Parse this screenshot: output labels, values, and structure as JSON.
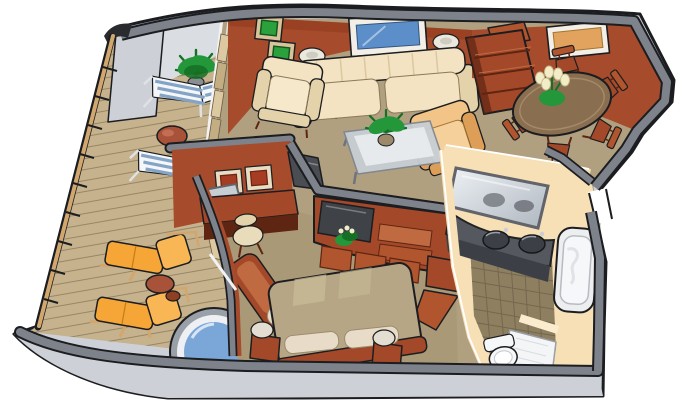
{
  "scene": {
    "kind": "isometric-suite-floorplan",
    "background": "#ffffff",
    "rooms": [
      {
        "name": "balcony",
        "furniture": [
          "deck-chair",
          "deck-chair",
          "round-table",
          "potted-plant",
          "sun-lounger",
          "sun-lounger",
          "side-table",
          "whirlpool-tub",
          "railing"
        ]
      },
      {
        "name": "living-room",
        "furniture": [
          "sofa",
          "armchair-cream",
          "armchair-tan",
          "table-lamp",
          "table-lamp",
          "end-table",
          "end-table",
          "glass-coffee-table",
          "potted-plant",
          "tv-cabinet",
          "television",
          "wall-art-blue",
          "wall-art-green",
          "wall-art-green",
          "curtains"
        ]
      },
      {
        "name": "dining-room",
        "furniture": [
          "dining-table",
          "dining-chair",
          "dining-chair",
          "dining-chair",
          "dining-chair",
          "dining-chair",
          "bookshelf",
          "flower-bouquet",
          "wall-art-orange"
        ]
      },
      {
        "name": "bedroom",
        "furniture": [
          "bed",
          "pillow",
          "pillow",
          "nightstand",
          "nightstand",
          "bedside-lamp",
          "bedside-lamp",
          "desk",
          "desk-mirror",
          "desk-chair",
          "chaise",
          "wardrobe",
          "television",
          "wall-art-red",
          "wall-art-red",
          "potted-plant"
        ]
      },
      {
        "name": "bathroom",
        "furniture": [
          "double-sink-vanity",
          "vanity-mirror",
          "bathtub",
          "shower",
          "toilet",
          "tile-floor"
        ]
      }
    ]
  },
  "palette": {
    "outline": "#1c1d20",
    "hull_face": "#cdd1d7",
    "hull_face_light": "#dadde1",
    "hull_band": "#7d828b",
    "rail_wood": "#d2a76e",
    "deck": "#c6b28d",
    "deck_line": "#8f7e5d",
    "carpet": "#b0a080",
    "carpet_dark": "#a69674",
    "wall_red": "#a64b2b",
    "wall_red_dark": "#8f3a1e",
    "wall_red_light": "#c06a42",
    "wood": "#a3492a",
    "wood_light": "#b1552f",
    "wood_dark": "#5e2512",
    "cream": "#f3e3c3",
    "cream_dark": "#e4d2aa",
    "tan": "#f2c488",
    "tan_dark": "#dd9f58",
    "lounge_orange": "#f6a637",
    "lounge_orange_light": "#f8b654",
    "stripe_blue": "#84a4c6",
    "white": "#f4f6f8",
    "water": "#7aa7d8",
    "glass": "#c7ced4",
    "glass_hi": "#edf1f4",
    "lamp": "#ebe8de",
    "plant": "#23973a",
    "plant_dark": "#156f24",
    "flower": "#f2ecc8",
    "bed": "#b7a685",
    "bed_light": "#c9bb98",
    "pillow": "#e8dcc8",
    "art_blue": "#5c8fc9",
    "art_orange": "#e2a35e",
    "art_green": "#2aa13c",
    "frame_white": "#f3efe6",
    "bath_wall": "#f7dfb6",
    "bath_wall_light": "#fbeccd",
    "tile": "#8d7f60",
    "tile_line": "#6e6248",
    "counter": "#55585e",
    "counter_dark": "#3c3f45",
    "fixture": "#f6f7f8",
    "mirror_frame": "#61646a",
    "tv": "#3f4246",
    "grey_steel": "#8a8d92"
  }
}
